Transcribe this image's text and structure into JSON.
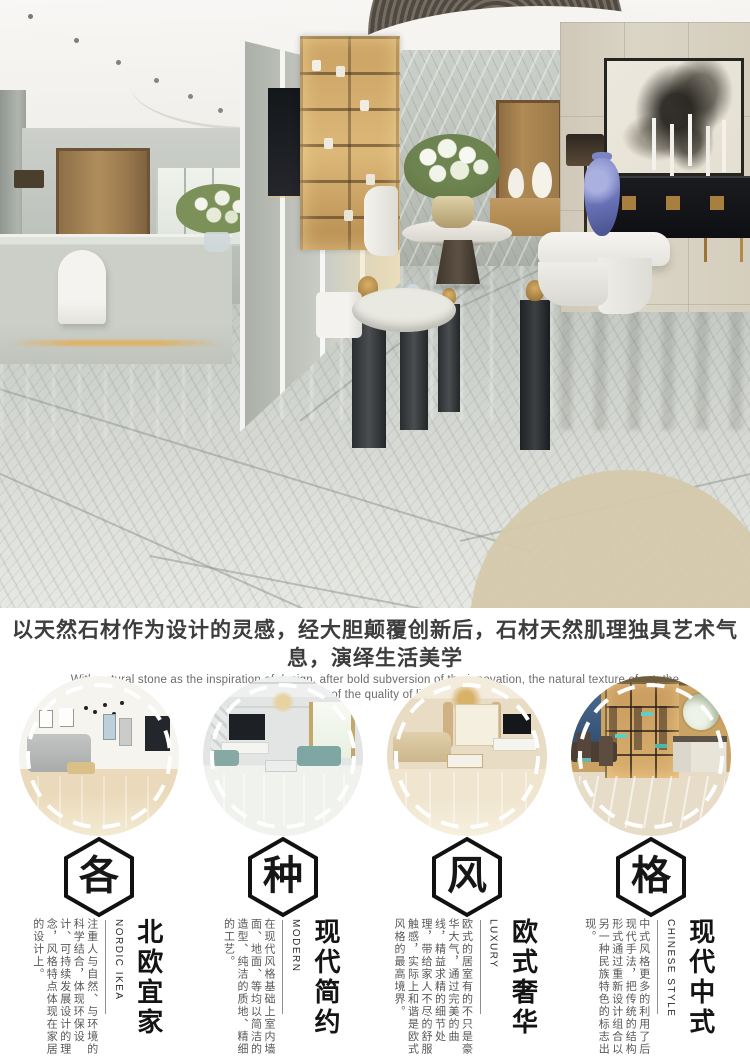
{
  "intro": {
    "headline": "以天然石材作为设计的灵感，经大胆颠覆创新后，石材天然肌理独具艺术气息，演绎生活美学",
    "subline1": "With natural stone as the inspiration of design, after bold subversion of the innovation, the natural texture of art, the",
    "subline2": "interpretation of the quality of life aesthetics."
  },
  "styles": {
    "items": [
      {
        "badge": "各",
        "title": "北欧宜家",
        "title_en": "NORDIC IKEA",
        "desc": "注重人与自然、与环境的科学结合，体现环保设计、可持续发展设计的理念，风格特点体现在家居的设计上。"
      },
      {
        "badge": "种",
        "title": "现代简约",
        "title_en": "MODERN",
        "desc": "在现代风格基础上室内墙面、地面、等均以简洁的造型、纯洁的质地、精细的工艺。"
      },
      {
        "badge": "风",
        "title": "欧式奢华",
        "title_en": "LUXURY",
        "desc": "欧式的居室有的不只是豪华大气，通过完美的曲线，精益求精的细节处理，带给家人不尽的舒服触感，实际上和谐是欧式风格的最高境界。"
      },
      {
        "badge": "格",
        "title": "现代中式",
        "title_en": "CHINESE STYLE",
        "desc": "中式风格更多的利用了后现代手法，把传统的结构形式通过重新设计组合以另一种民族特色的标志出现。"
      }
    ]
  },
  "colors": {
    "headline": "#3d3d3d",
    "body_text": "#585858",
    "badge_outline": "#111111",
    "dash_ring": "#ffffff"
  }
}
